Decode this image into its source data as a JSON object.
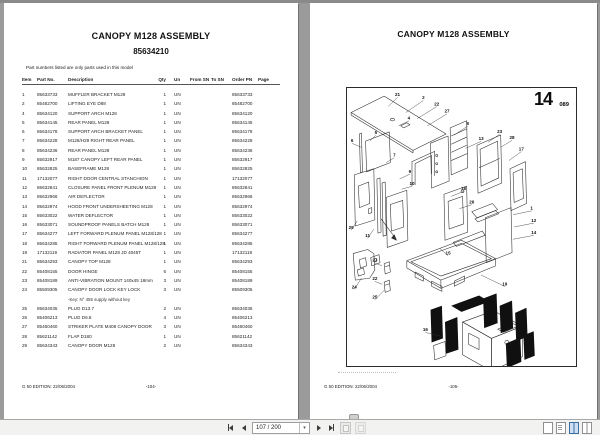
{
  "left_page": {
    "title": "CANOPY M128 ASSEMBLY",
    "subtitle": "85634210",
    "note": "Part numbers listed are only parts used in this model",
    "footer_left": "G 50 EDITION: 22/06/2004",
    "footer_center": "-104-",
    "table": {
      "headers": {
        "item": "Item",
        "part": "Part No.",
        "desc": "Description",
        "qty": "Qty",
        "un": "Un",
        "from_sn": "From SN",
        "to_sn": "To SN",
        "order_pn": "Order PN",
        "page": "Page"
      },
      "rows": [
        {
          "item": "1",
          "part": "85633733",
          "desc": "MUFFLER BRACKET M128",
          "qty": "1",
          "un": "UN",
          "from_sn": "",
          "to_sn": "",
          "order": "85633733",
          "page": ""
        },
        {
          "item": "2",
          "part": "85482700",
          "desc": "LIFTING EYE D88",
          "qty": "1",
          "un": "UN",
          "from_sn": "",
          "to_sn": "",
          "order": "85482700",
          "page": ""
        },
        {
          "item": "4",
          "part": "85634120",
          "desc": "SUPPORT ARCH M128",
          "qty": "1",
          "un": "UN",
          "from_sn": "",
          "to_sn": "",
          "order": "85634120",
          "page": ""
        },
        {
          "item": "5",
          "part": "85634145",
          "desc": "REAR PANEL M128",
          "qty": "1",
          "un": "UN",
          "from_sn": "",
          "to_sn": "",
          "order": "85634145",
          "page": ""
        },
        {
          "item": "6",
          "part": "85634178",
          "desc": "SUPPORT ARCH BRACKET PANEL",
          "qty": "1",
          "un": "UN",
          "from_sn": "",
          "to_sn": "",
          "order": "85634178",
          "page": ""
        },
        {
          "item": "7",
          "part": "85634228",
          "desc": "M128/H29 RIGHT REAR PANEL",
          "qty": "1",
          "un": "UN",
          "from_sn": "",
          "to_sn": "",
          "order": "85634228",
          "page": ""
        },
        {
          "item": "8",
          "part": "85634236",
          "desc": "REAR PANEL M128",
          "qty": "1",
          "un": "UN",
          "from_sn": "",
          "to_sn": "",
          "order": "85634236",
          "page": ""
        },
        {
          "item": "9",
          "part": "85632917",
          "desc": "M187 CANOPY LEFT REAR PANEL",
          "qty": "1",
          "un": "UN",
          "from_sn": "",
          "to_sn": "",
          "order": "85632917",
          "page": ""
        },
        {
          "item": "10",
          "part": "85632825",
          "desc": "BASEFRAME M128",
          "qty": "1",
          "un": "UN",
          "from_sn": "",
          "to_sn": "",
          "order": "85632825",
          "page": ""
        },
        {
          "item": "11",
          "part": "17132077",
          "desc": "RIGHT DOOR CENTRAL STANCHION",
          "qty": "1",
          "un": "UN",
          "from_sn": "",
          "to_sn": "",
          "order": "17132077",
          "page": ""
        },
        {
          "item": "12",
          "part": "85632841",
          "desc": "CLOSURE PANEL FRONT PLENUM M128",
          "qty": "1",
          "un": "UN",
          "from_sn": "",
          "to_sn": "",
          "order": "85632841",
          "page": ""
        },
        {
          "item": "13",
          "part": "85632966",
          "desc": "AIR DEFLECTOR",
          "qty": "1",
          "un": "UN",
          "from_sn": "",
          "to_sn": "",
          "order": "85632966",
          "page": ""
        },
        {
          "item": "14",
          "part": "85632974",
          "desc": "HOOD FRONT UNDERSHEETING M128",
          "qty": "1",
          "un": "UN",
          "from_sn": "",
          "to_sn": "",
          "order": "85632974",
          "page": ""
        },
        {
          "item": "15",
          "part": "85633022",
          "desc": "WATER DEFLECTOR",
          "qty": "1",
          "un": "UN",
          "from_sn": "",
          "to_sn": "",
          "order": "85633022",
          "page": ""
        },
        {
          "item": "16",
          "part": "85633071",
          "desc": "SOUNDPROOF PANELS BATCH M128",
          "qty": "1",
          "un": "UN",
          "from_sn": "",
          "to_sn": "",
          "order": "85633071",
          "page": ""
        },
        {
          "item": "17",
          "part": "85634277",
          "desc": "LEFT FORWARD PLENUM PANEL M128/128",
          "qty": "1",
          "un": "UN",
          "from_sn": "",
          "to_sn": "",
          "order": "85634277",
          "page": ""
        },
        {
          "item": "18",
          "part": "85634285",
          "desc": "RIGHT FORWARD PLENUM PANEL M128/128",
          "qty": "1",
          "un": "UN",
          "from_sn": "",
          "to_sn": "",
          "order": "85634285",
          "page": ""
        },
        {
          "item": "19",
          "part": "17132119",
          "desc": "RADIATOR PANEL M128 JD 4045T",
          "qty": "1",
          "un": "UN",
          "from_sn": "",
          "to_sn": "",
          "order": "17132119",
          "page": ""
        },
        {
          "item": "21",
          "part": "85634293",
          "desc": "CANOPY TOP M128",
          "qty": "1",
          "un": "UN",
          "from_sn": "",
          "to_sn": "",
          "order": "85634293",
          "page": ""
        },
        {
          "item": "22",
          "part": "85408155",
          "desc": "DOOR HINGE",
          "qty": "6",
          "un": "UN",
          "from_sn": "",
          "to_sn": "",
          "order": "85408155",
          "page": ""
        },
        {
          "item": "23",
          "part": "85408189",
          "desc": "ANTI-VIBRATION MOUNT 140x45 18mm",
          "qty": "3",
          "un": "UN",
          "from_sn": "",
          "to_sn": "",
          "order": "85408189",
          "page": ""
        },
        {
          "item": "24",
          "part": "85509305",
          "desc": "CANOPY DOOR LOCK KEY LOCK",
          "qty": "3",
          "un": "UN",
          "from_sn": "",
          "to_sn": "",
          "order": "85509305",
          "page": "",
          "note": "-Key: N° 455 supply without key"
        },
        {
          "item": "25",
          "part": "85634035",
          "desc": "PLUG D13.7",
          "qty": "2",
          "un": "UN",
          "from_sn": "",
          "to_sn": "",
          "order": "85634035",
          "page": ""
        },
        {
          "item": "26",
          "part": "85406213",
          "desc": "PLUG D6.8",
          "qty": "4",
          "un": "UN",
          "from_sn": "",
          "to_sn": "",
          "order": "85406213",
          "page": ""
        },
        {
          "item": "27",
          "part": "85460460",
          "desc": "STRIKER PLATE M408 CANOPY DOOR",
          "qty": "3",
          "un": "UN",
          "from_sn": "",
          "to_sn": "",
          "order": "85460460",
          "page": ""
        },
        {
          "item": "28",
          "part": "85621142",
          "desc": "FLAP D180",
          "qty": "1",
          "un": "UN",
          "from_sn": "",
          "to_sn": "",
          "order": "85621142",
          "page": ""
        },
        {
          "item": "29",
          "part": "85634343",
          "desc": "CANOPY DOOR M128",
          "qty": "2",
          "un": "UN",
          "from_sn": "",
          "to_sn": "",
          "order": "85634343",
          "page": ""
        }
      ]
    }
  },
  "right_page": {
    "title": "CANOPY M128 ASSEMBLY",
    "figure_number": "14",
    "figure_code": "089",
    "footer_left": "G 50 EDITION: 22/06/2004",
    "footer_center": "-105-",
    "callouts": [
      {
        "n": "21",
        "x": 49,
        "y": 8,
        "lx": 40,
        "ly": 18
      },
      {
        "n": "2",
        "x": 74,
        "y": 11,
        "lx": 57,
        "ly": 24
      },
      {
        "n": "22",
        "x": 87,
        "y": 17,
        "lx": 68,
        "ly": 30
      },
      {
        "n": "27",
        "x": 97,
        "y": 24,
        "lx": 78,
        "ly": 37
      },
      {
        "n": "4",
        "x": 60,
        "y": 31,
        "lx": 50,
        "ly": 37
      },
      {
        "n": "8",
        "x": 117,
        "y": 36,
        "lx": 104,
        "ly": 46
      },
      {
        "n": "13",
        "x": 130,
        "y": 51,
        "lx": 115,
        "ly": 59
      },
      {
        "n": "23",
        "x": 148,
        "y": 44,
        "lx": 137,
        "ly": 53
      },
      {
        "n": "28",
        "x": 160,
        "y": 50,
        "lx": 149,
        "ly": 58
      },
      {
        "n": "17",
        "x": 169,
        "y": 61,
        "lx": 157,
        "ly": 71
      },
      {
        "n": "6",
        "x": 5,
        "y": 53,
        "lx": 14,
        "ly": 58
      },
      {
        "n": "5",
        "x": 28,
        "y": 45,
        "lx": 22,
        "ly": 52
      },
      {
        "n": "7",
        "x": 46,
        "y": 67,
        "lx": 38,
        "ly": 73
      },
      {
        "n": "9",
        "x": 61,
        "y": 83,
        "lx": 51,
        "ly": 89
      },
      {
        "n": "10",
        "x": 63,
        "y": 95,
        "lx": 53,
        "ly": 99
      },
      {
        "n": "18",
        "x": 113,
        "y": 100,
        "lx": 101,
        "ly": 106
      },
      {
        "n": "26",
        "x": 121,
        "y": 113,
        "lx": 109,
        "ly": 118
      },
      {
        "n": "1",
        "x": 179,
        "y": 119,
        "lx": 161,
        "ly": 124
      },
      {
        "n": "12",
        "x": 181,
        "y": 131,
        "lx": 162,
        "ly": 136
      },
      {
        "n": "14",
        "x": 181,
        "y": 143,
        "lx": 161,
        "ly": 148
      },
      {
        "n": "29",
        "x": 4,
        "y": 138,
        "lx": 10,
        "ly": 130
      },
      {
        "n": "11",
        "x": 20,
        "y": 146,
        "lx": 26,
        "ly": 138
      },
      {
        "n": "24",
        "x": 7,
        "y": 196,
        "lx": 14,
        "ly": 186
      },
      {
        "n": "27",
        "x": 27,
        "y": 170,
        "lx": 34,
        "ly": 174
      },
      {
        "n": "22",
        "x": 27,
        "y": 188,
        "lx": 34,
        "ly": 192
      },
      {
        "n": "25",
        "x": 27,
        "y": 206,
        "lx": 36,
        "ly": 198
      },
      {
        "n": "15",
        "x": 98,
        "y": 163,
        "lx": 90,
        "ly": 157
      },
      {
        "n": "19",
        "x": 153,
        "y": 193,
        "lx": 130,
        "ly": 183
      },
      {
        "n": "16",
        "x": 76,
        "y": 238,
        "lx": 92,
        "ly": 243
      }
    ]
  },
  "toolbar": {
    "page_indicator": "107 / 200",
    "icons": {
      "first_page": "first-page-icon",
      "previous_page": "previous-page-icon",
      "next_page": "next-page-icon",
      "last_page": "last-page-icon",
      "previous_view": "previous-view-icon",
      "next_view": "next-view-icon",
      "single_page_view": "single-page-view-icon",
      "continuous_view": "continuous-view-icon",
      "two_page_view": "two-page-view-icon",
      "two_page_continuous_view": "two-page-continuous-view-icon"
    },
    "colors": {
      "active_view_accent": "#3a6ea5",
      "toolbar_bg": "#f2f2f0",
      "background": "#9b9b9b"
    }
  }
}
